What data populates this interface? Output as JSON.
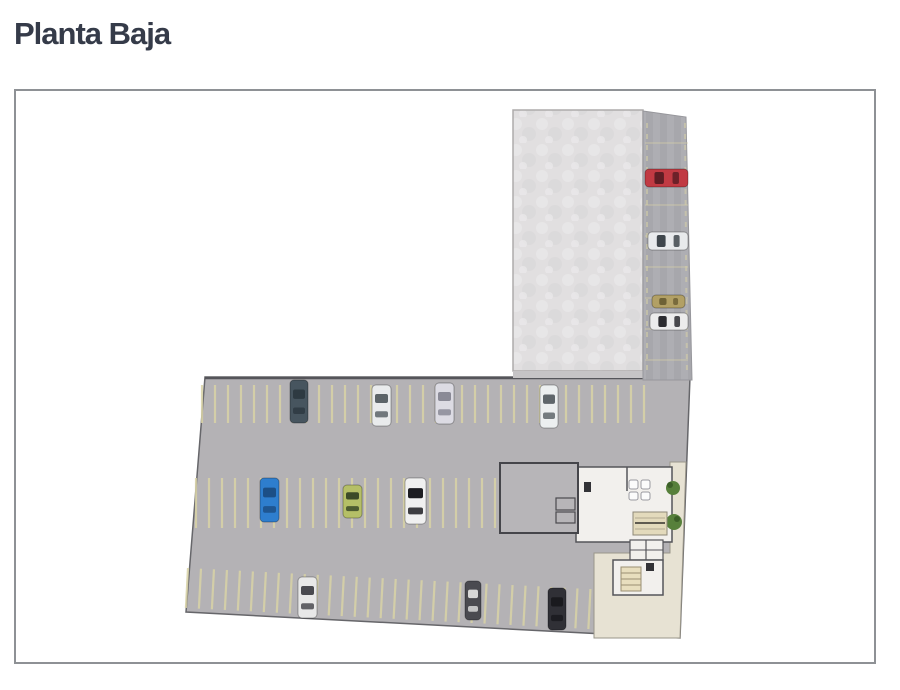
{
  "page": {
    "title": "Planta Baja"
  },
  "colors": {
    "title": "#353b49",
    "box_border": "#8e9195",
    "lot": "#b4b2b5",
    "lot_edge": "#5d5d61",
    "slab": "#e1dfe0",
    "slab_edge": "#aeabab",
    "strip_dark": "#a7a7ac",
    "strip_light": "#aeaeb3",
    "under_slab_band": "#c6c4c6",
    "dash": "#d9d3a6",
    "strip_dash": "#d8d2a8",
    "wall": "#4c4c50",
    "room_gray": "#b7b5b8",
    "room_white": "#f2f0ed",
    "beige_floor": "#e7e2d3",
    "beige_stairs": "#e3dabc",
    "stairs_tan": "#e8debe",
    "fixture_white": "#fbfbfb",
    "fixture_dark": "#323236",
    "plant_green": "#57803b",
    "plant_green_dark": "#3c5f28"
  },
  "plan": {
    "cars": [
      {
        "x": 274,
        "y": 289,
        "w": 18,
        "h": 43,
        "o": "v",
        "body": "#47555f",
        "glass": "#2e3a42"
      },
      {
        "x": 356,
        "y": 294,
        "w": 19,
        "h": 41,
        "o": "v",
        "body": "#e9ebec",
        "glass": "#5c6468"
      },
      {
        "x": 419,
        "y": 292,
        "w": 19,
        "h": 41,
        "o": "v",
        "body": "#dcdbe3",
        "glass": "#8a8a96"
      },
      {
        "x": 524,
        "y": 294,
        "w": 18,
        "h": 43,
        "o": "v",
        "body": "#eceff0",
        "glass": "#5f666b"
      },
      {
        "x": 244,
        "y": 387,
        "w": 19,
        "h": 44,
        "o": "v",
        "body": "#2e7ece",
        "glass": "#1c4f86"
      },
      {
        "x": 327,
        "y": 394,
        "w": 19,
        "h": 33,
        "o": "v",
        "body": "#b5bf67",
        "glass": "#3c4a28"
      },
      {
        "x": 389,
        "y": 387,
        "w": 21,
        "h": 46,
        "o": "v",
        "body": "#f0f0f0",
        "glass": "#1d1d22"
      },
      {
        "x": 282,
        "y": 486,
        "w": 19,
        "h": 41,
        "o": "v",
        "body": "#e8e8e8",
        "glass": "#4a4a50"
      },
      {
        "x": 449,
        "y": 490,
        "w": 16,
        "h": 39,
        "o": "v",
        "body": "#4a4a50",
        "glass": "#d8d8d8"
      },
      {
        "x": 532,
        "y": 497,
        "w": 18,
        "h": 42,
        "o": "v",
        "body": "#303036",
        "glass": "#1a1a1e"
      },
      {
        "x": 629,
        "y": 78,
        "w": 43,
        "h": 18,
        "o": "h",
        "body": "#c13a43",
        "glass": "#5e1d24"
      },
      {
        "x": 632,
        "y": 141,
        "w": 40,
        "h": 18,
        "o": "h",
        "body": "#e8eaec",
        "glass": "#3f464c"
      },
      {
        "x": 636,
        "y": 204,
        "w": 33,
        "h": 13,
        "o": "h",
        "body": "#b2a065",
        "glass": "#6e6236"
      },
      {
        "x": 634,
        "y": 222,
        "w": 38,
        "h": 17,
        "o": "h",
        "body": "#ececec",
        "glass": "#2c2c30"
      }
    ],
    "dash_rows": [
      {
        "dir": "v",
        "x": 186,
        "y": 294,
        "span": 448,
        "size": 38,
        "spacing": 13,
        "tilt": 0
      },
      {
        "dir": "v",
        "x": 180,
        "y": 387,
        "span": 302,
        "size": 50,
        "spacing": 13,
        "tilt": 0
      },
      {
        "dir": "v",
        "x": 172,
        "y": 477,
        "span": 418,
        "size": 40,
        "spacing": 13,
        "tilt": 3
      },
      {
        "dir": "h",
        "x": 629,
        "y": 52,
        "span": 43,
        "size": 0,
        "spacing": 31,
        "count": 8,
        "tilt": 0
      }
    ]
  }
}
